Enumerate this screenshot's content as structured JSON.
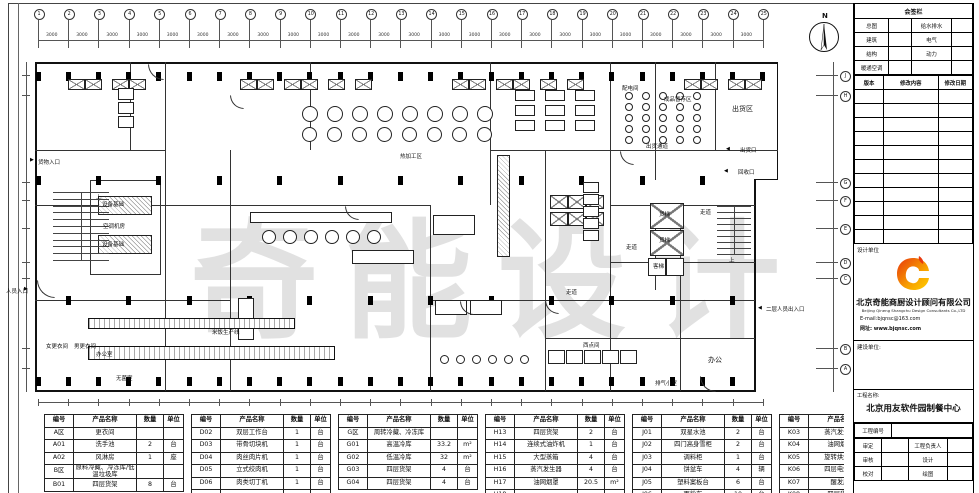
{
  "colors": {
    "line": "#111111",
    "watermark": "#d7d7d7",
    "logo_red": "#e8380d",
    "logo_orange": "#f7a000",
    "logo_yellow": "#ffcf00"
  },
  "plan": {
    "north_label": "N",
    "watermark": "奇能设计",
    "dim_span": "3000",
    "grid_cols": [
      "1",
      "2",
      "3",
      "4",
      "5",
      "6",
      "7",
      "8",
      "9",
      "10",
      "11",
      "12",
      "13",
      "14",
      "15",
      "16",
      "17",
      "18",
      "19",
      "20",
      "21",
      "22",
      "23",
      "24",
      "25"
    ],
    "grid_rows": [
      "J",
      "H",
      "G",
      "F",
      "E",
      "D",
      "C",
      "B",
      "A"
    ],
    "room_labels": [
      {
        "text": "货物入口",
        "x": 38,
        "y": 158,
        "big": false
      },
      {
        "text": "上",
        "x": 96,
        "y": 193,
        "big": false
      },
      {
        "text": "设备基础",
        "x": 102,
        "y": 200,
        "big": false
      },
      {
        "text": "空调机房",
        "x": 103,
        "y": 222,
        "big": false
      },
      {
        "text": "设备基础",
        "x": 102,
        "y": 240,
        "big": false
      },
      {
        "text": "热加工区",
        "x": 400,
        "y": 152,
        "big": false
      },
      {
        "text": "配电间",
        "x": 622,
        "y": 84,
        "big": false
      },
      {
        "text": "成品暂存区",
        "x": 664,
        "y": 95,
        "big": false
      },
      {
        "text": "出货区",
        "x": 732,
        "y": 104,
        "big": true
      },
      {
        "text": "出货通道",
        "x": 646,
        "y": 142,
        "big": false
      },
      {
        "text": "出货口",
        "x": 740,
        "y": 146,
        "big": false
      },
      {
        "text": "回收口",
        "x": 738,
        "y": 168,
        "big": false
      },
      {
        "text": "走道",
        "x": 700,
        "y": 208,
        "big": false
      },
      {
        "text": "货梯",
        "x": 659,
        "y": 210,
        "big": false
      },
      {
        "text": "货梯",
        "x": 659,
        "y": 236,
        "big": false
      },
      {
        "text": "客梯",
        "x": 653,
        "y": 262,
        "big": false
      },
      {
        "text": "上",
        "x": 729,
        "y": 256,
        "big": false
      },
      {
        "text": "走道",
        "x": 626,
        "y": 243,
        "big": false
      },
      {
        "text": "走道",
        "x": 566,
        "y": 288,
        "big": false
      },
      {
        "text": "办公",
        "x": 708,
        "y": 355,
        "big": true
      },
      {
        "text": "排气小室",
        "x": 655,
        "y": 379,
        "big": false
      },
      {
        "text": "人员入口",
        "x": 6,
        "y": 287,
        "big": false
      },
      {
        "text": "米饭生产线",
        "x": 212,
        "y": 328,
        "big": false
      },
      {
        "text": "西点间",
        "x": 583,
        "y": 341,
        "big": false
      },
      {
        "text": "办公室",
        "x": 96,
        "y": 350,
        "big": false
      },
      {
        "text": "女更衣间",
        "x": 46,
        "y": 342,
        "big": false
      },
      {
        "text": "男更衣间",
        "x": 74,
        "y": 342,
        "big": false
      },
      {
        "text": "无菌室",
        "x": 116,
        "y": 374,
        "big": false
      },
      {
        "text": "二层人员出入口",
        "x": 766,
        "y": 305,
        "big": false
      }
    ]
  },
  "tables": {
    "headers": [
      "编号",
      "产品名称",
      "数量",
      "单位"
    ],
    "groups": [
      {
        "rows": [
          [
            "A区",
            "更衣间",
            "",
            ""
          ],
          [
            "A01",
            "洗手池",
            "2",
            "台"
          ],
          [
            "A02",
            "风淋房",
            "1",
            "座"
          ],
          [
            "B区",
            "原料冷藏、冷冻库/低温垃圾库",
            "",
            ""
          ],
          [
            "B01",
            "四层货架",
            "8",
            "台"
          ]
        ]
      },
      {
        "rows": [
          [
            "D02",
            "双层工作台",
            "1",
            "台"
          ],
          [
            "D03",
            "带骨切块机",
            "1",
            "台"
          ],
          [
            "D04",
            "肉丝肉片机",
            "1",
            "台"
          ],
          [
            "D05",
            "立式绞肉机",
            "1",
            "台"
          ],
          [
            "D06",
            "肉类切丁机",
            "1",
            "台"
          ],
          [
            "",
            "",
            "",
            ""
          ]
        ]
      },
      {
        "rows": [
          [
            "G区",
            "周转冷藏、冷冻库",
            "",
            ""
          ],
          [
            "G01",
            "高温冷库",
            "33.2",
            "m²"
          ],
          [
            "G02",
            "低温冷库",
            "32",
            "m²"
          ],
          [
            "G03",
            "四层货架",
            "4",
            "台"
          ],
          [
            "G04",
            "四层货架",
            "4",
            "台"
          ]
        ]
      },
      {
        "rows": [
          [
            "H13",
            "四层货架",
            "2",
            "台"
          ],
          [
            "H14",
            "连续式油炸机",
            "1",
            "台"
          ],
          [
            "H15",
            "大型蒸箱",
            "4",
            "台"
          ],
          [
            "H16",
            "蒸汽发生器",
            "4",
            "台"
          ],
          [
            "H17",
            "油网烟罩",
            "20.5",
            "m²"
          ],
          [
            "H18",
            "",
            "",
            ""
          ]
        ]
      },
      {
        "rows": [
          [
            "J01",
            "双星水池",
            "2",
            "台"
          ],
          [
            "J02",
            "四门高身雪柜",
            "2",
            "台"
          ],
          [
            "J03",
            "调料柜",
            "1",
            "台"
          ],
          [
            "J04",
            "饼盆车",
            "4",
            "辆"
          ],
          [
            "J05",
            "塑料案板台",
            "6",
            "台"
          ],
          [
            "J06",
            "面粉车",
            "10",
            "台"
          ]
        ]
      },
      {
        "rows": [
          [
            "K03",
            "蒸汽发生器",
            "3",
            "台"
          ],
          [
            "K04",
            "油网烟罩",
            "9.4",
            "m²"
          ],
          [
            "K05",
            "旋转烘烤炉",
            "2",
            "台"
          ],
          [
            "K06",
            "四层电焗炉",
            "1",
            "台"
          ],
          [
            "K07",
            "醒发库",
            "31",
            "m²"
          ],
          [
            "K08",
            "四层货架",
            "5",
            "台"
          ]
        ]
      }
    ]
  },
  "titleblock": {
    "sign_title": "会签栏",
    "sign_rows": [
      [
        "总图",
        "给水排水"
      ],
      [
        "建筑",
        "电气"
      ],
      [
        "结构",
        "动力"
      ],
      [
        "暖通空调",
        ""
      ]
    ],
    "rev_headers": [
      "版本",
      "修改内容",
      "修改日期"
    ],
    "design_unit_label": "设计单位",
    "company_cn": "北京奇能商厨设计顾问有限公司",
    "company_en": "Beijing Qineng Shangchu Design Consultants Co.,LTD",
    "email": "E-mail:bjqnsc@163.com",
    "website": "网址: www.bjqnsc.com",
    "build_unit_label": "建设单位:",
    "project_name_label": "工程名称:",
    "project_name": "北京用友软件园制餐中心",
    "project_no_label": "工程编号",
    "field_rows": [
      [
        "审定",
        "工程负责人"
      ],
      [
        "审核",
        "设计"
      ],
      [
        "校对",
        "绘图"
      ]
    ]
  }
}
